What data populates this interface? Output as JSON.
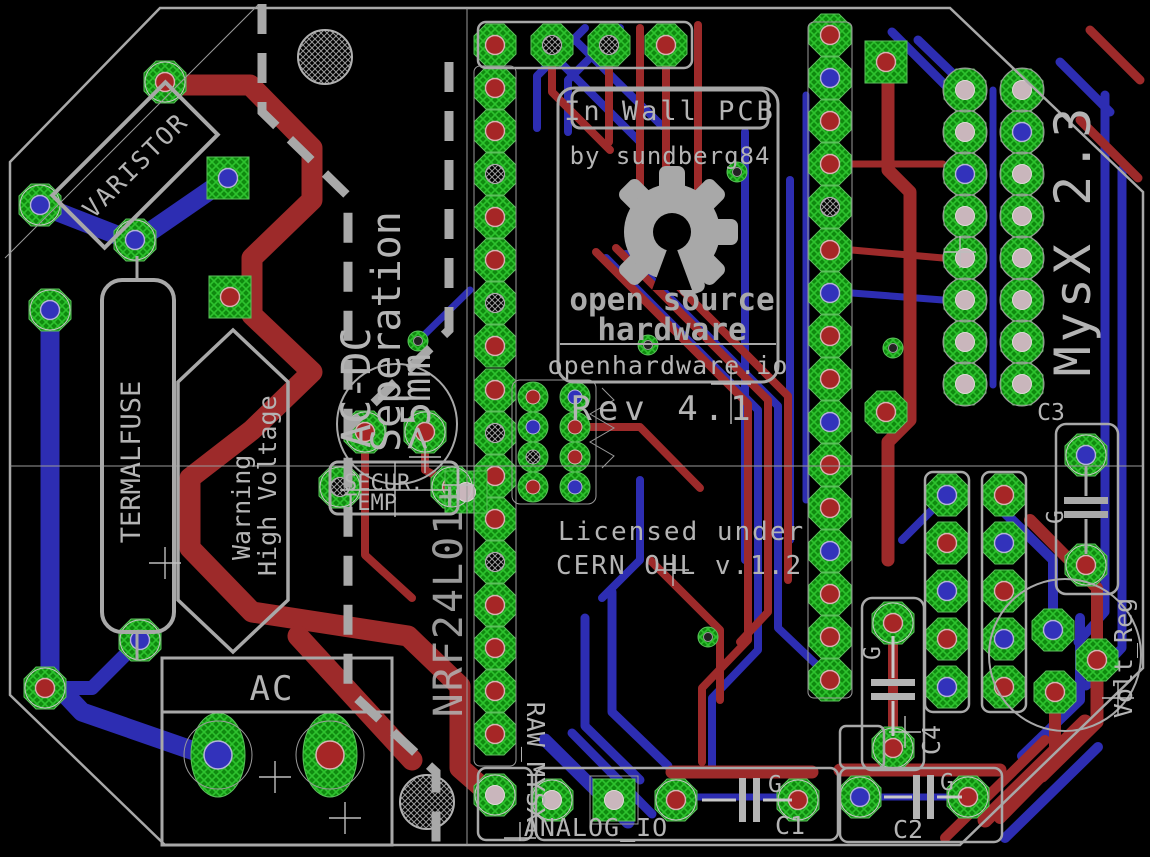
{
  "board": {
    "title": "In Wall PCB",
    "byline": "by sundberg84",
    "oshw_line1": "open source",
    "oshw_line2": "hardware",
    "site": "openhardware.io",
    "revision": "Rev 4.1",
    "license_line1": "Licensed under",
    "license_line2": "CERN OHL v.1.2",
    "mysx_version": "MysX 2.3"
  },
  "labels": {
    "varistor": "VARISTOR",
    "acdc_sep_line1": "AC-DC",
    "acdc_sep_line2": "Seperation",
    "acdc_sep_line3": ">5mm",
    "warning_line1": "Warning",
    "warning_line2": "High Voltage",
    "termalfuse": "TERMALFUSE",
    "secur_line1": "SECUR.",
    "secur_line2": "TEMP",
    "ac_terminal": "AC",
    "radio": "NRF24L01+",
    "raw_mysx": "RAW_MYSX",
    "analog_io": "ANALOG_IO",
    "c1": "C1",
    "c2": "C2",
    "c3": "C3",
    "c4": "C4",
    "ground": "G",
    "volt_reg": "Volt_Reg"
  },
  "colors": {
    "background": "#000000",
    "copper_top": "#9d2a2a",
    "copper_bottom": "#2d2db2",
    "pad_green": "#15a015",
    "silkscreen": "#b4b4b4"
  }
}
